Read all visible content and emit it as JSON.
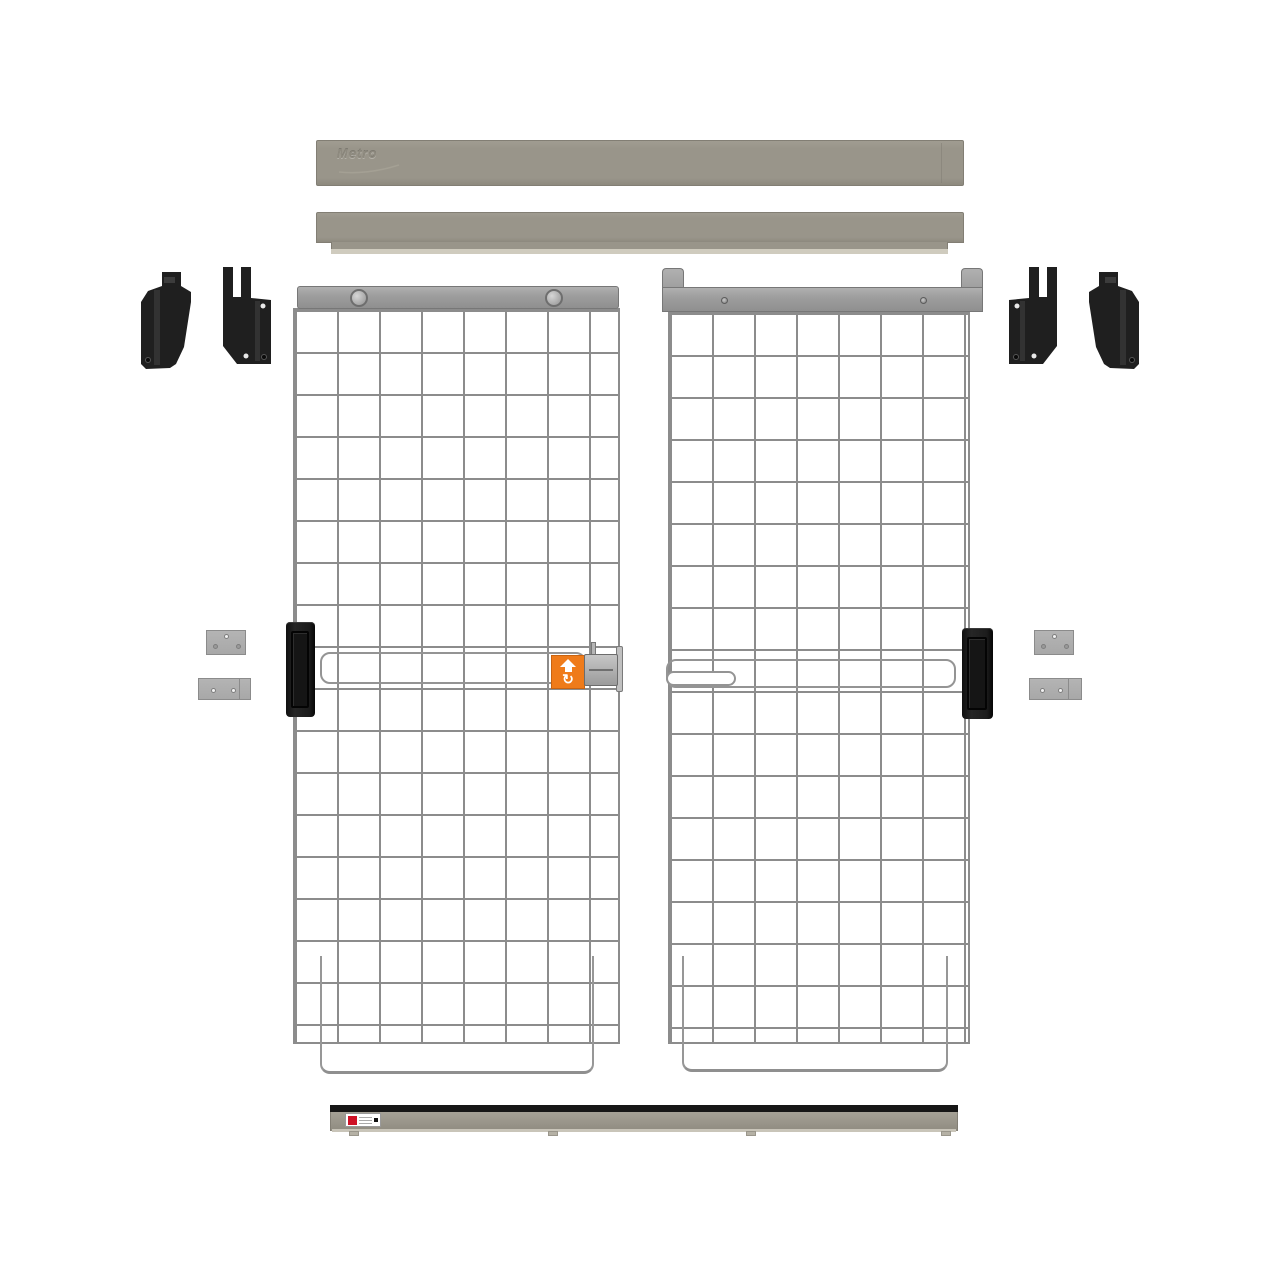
{
  "canvas": {
    "width": 1280,
    "height": 1280,
    "background": "#FFFFFF"
  },
  "branding": {
    "top_rail_logo": "Metro"
  },
  "icons": {
    "latch_sticker_arrow": "arrow-up-icon",
    "rotate_glyph": "↻",
    "bottom_label_brand": "metro-logo-mark-icon"
  },
  "colors": {
    "background": "#FFFFFF",
    "rail": "#99958A",
    "rail_edge": "#827E74",
    "rail_lip": "#CFCBBE",
    "header": "#9E9E9E",
    "header_edge": "#777777",
    "mesh": "#8C8C8C",
    "black_part": "#1F1F1F",
    "plate": "#A8A8A8",
    "plate_edge": "#8B8B8B",
    "orange": "#EF7B1A",
    "label_red": "#CE1126",
    "track_black": "#161616"
  },
  "parts": {
    "top_retainer_bar": "top-retainer-bar",
    "top_track_channel": "top-track-channel",
    "corner_brackets_left": 2,
    "corner_brackets_right": 2,
    "left_door": {
      "rollers": 2,
      "handle": 1,
      "latch_sticker": 1,
      "latch_assembly": 1,
      "slide_channel": 1,
      "bottom_guide_loop": 1
    },
    "right_door": {
      "header_screws": 2,
      "handle": 1,
      "slide_channel": 1,
      "slide_pill": 1,
      "bottom_guide_loop": 1
    },
    "wall_plates_left": 2,
    "wall_plates_right": 2,
    "bottom_track": {
      "label": 1,
      "mounting_tabs": 4
    }
  }
}
